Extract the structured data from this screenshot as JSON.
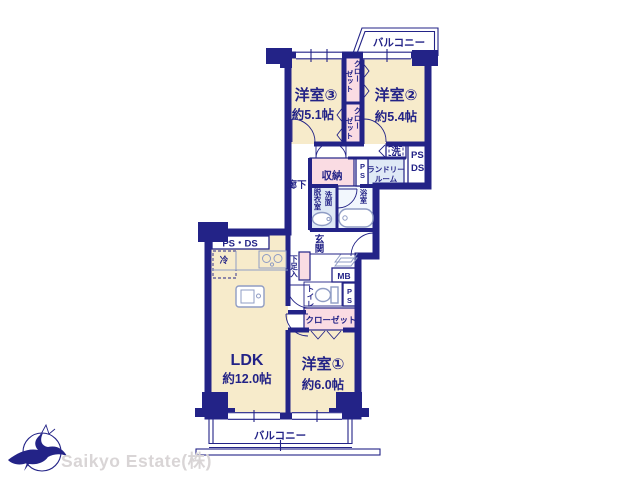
{
  "colors": {
    "navy": "#232387",
    "cream": "#f7ebcb",
    "pink": "#fadce3",
    "blue": "#dfe9f6",
    "bath": "#f2f7fd",
    "fixture": "#8f9cc4",
    "gray_text": "#d9d5d6"
  },
  "branding": {
    "company": "Saikyo Estate(株)"
  },
  "balconies": {
    "top": "バルコニー",
    "bottom": "バルコニー"
  },
  "rooms": {
    "western3": {
      "name": "洋室③",
      "size": "約5.1帖"
    },
    "western2": {
      "name": "洋室②",
      "size": "約5.4帖"
    },
    "western1": {
      "name": "洋室①",
      "size": "約6.0帖"
    },
    "ldk": {
      "name": "LDK",
      "size": "約12.0帖"
    }
  },
  "closets": {
    "upper": {
      "line1": "クロー",
      "line2": "ゼット"
    },
    "lower": {
      "line1": "クロー",
      "line2": "ゼット"
    },
    "bedroom1": "クローゼット"
  },
  "utility": {
    "corridor": "廊下",
    "entrance": "玄関",
    "shoe_cabinet": "下足入",
    "storage": "収納",
    "laundry_room": {
      "line1": "ランドリー",
      "line2": "ルーム"
    },
    "washer": "洗",
    "bathroom": "浴室",
    "washroom": {
      "right": "洗面",
      "left": "脱衣室"
    },
    "toilet": "トイレ",
    "meter_box": "MB",
    "ps_hall": "PS",
    "ps_toilet": "PS",
    "ps_ds": {
      "line1": "PS",
      "line2": "DS"
    },
    "ps_ds_ldk": "PS・DS",
    "fridge": "冷"
  }
}
